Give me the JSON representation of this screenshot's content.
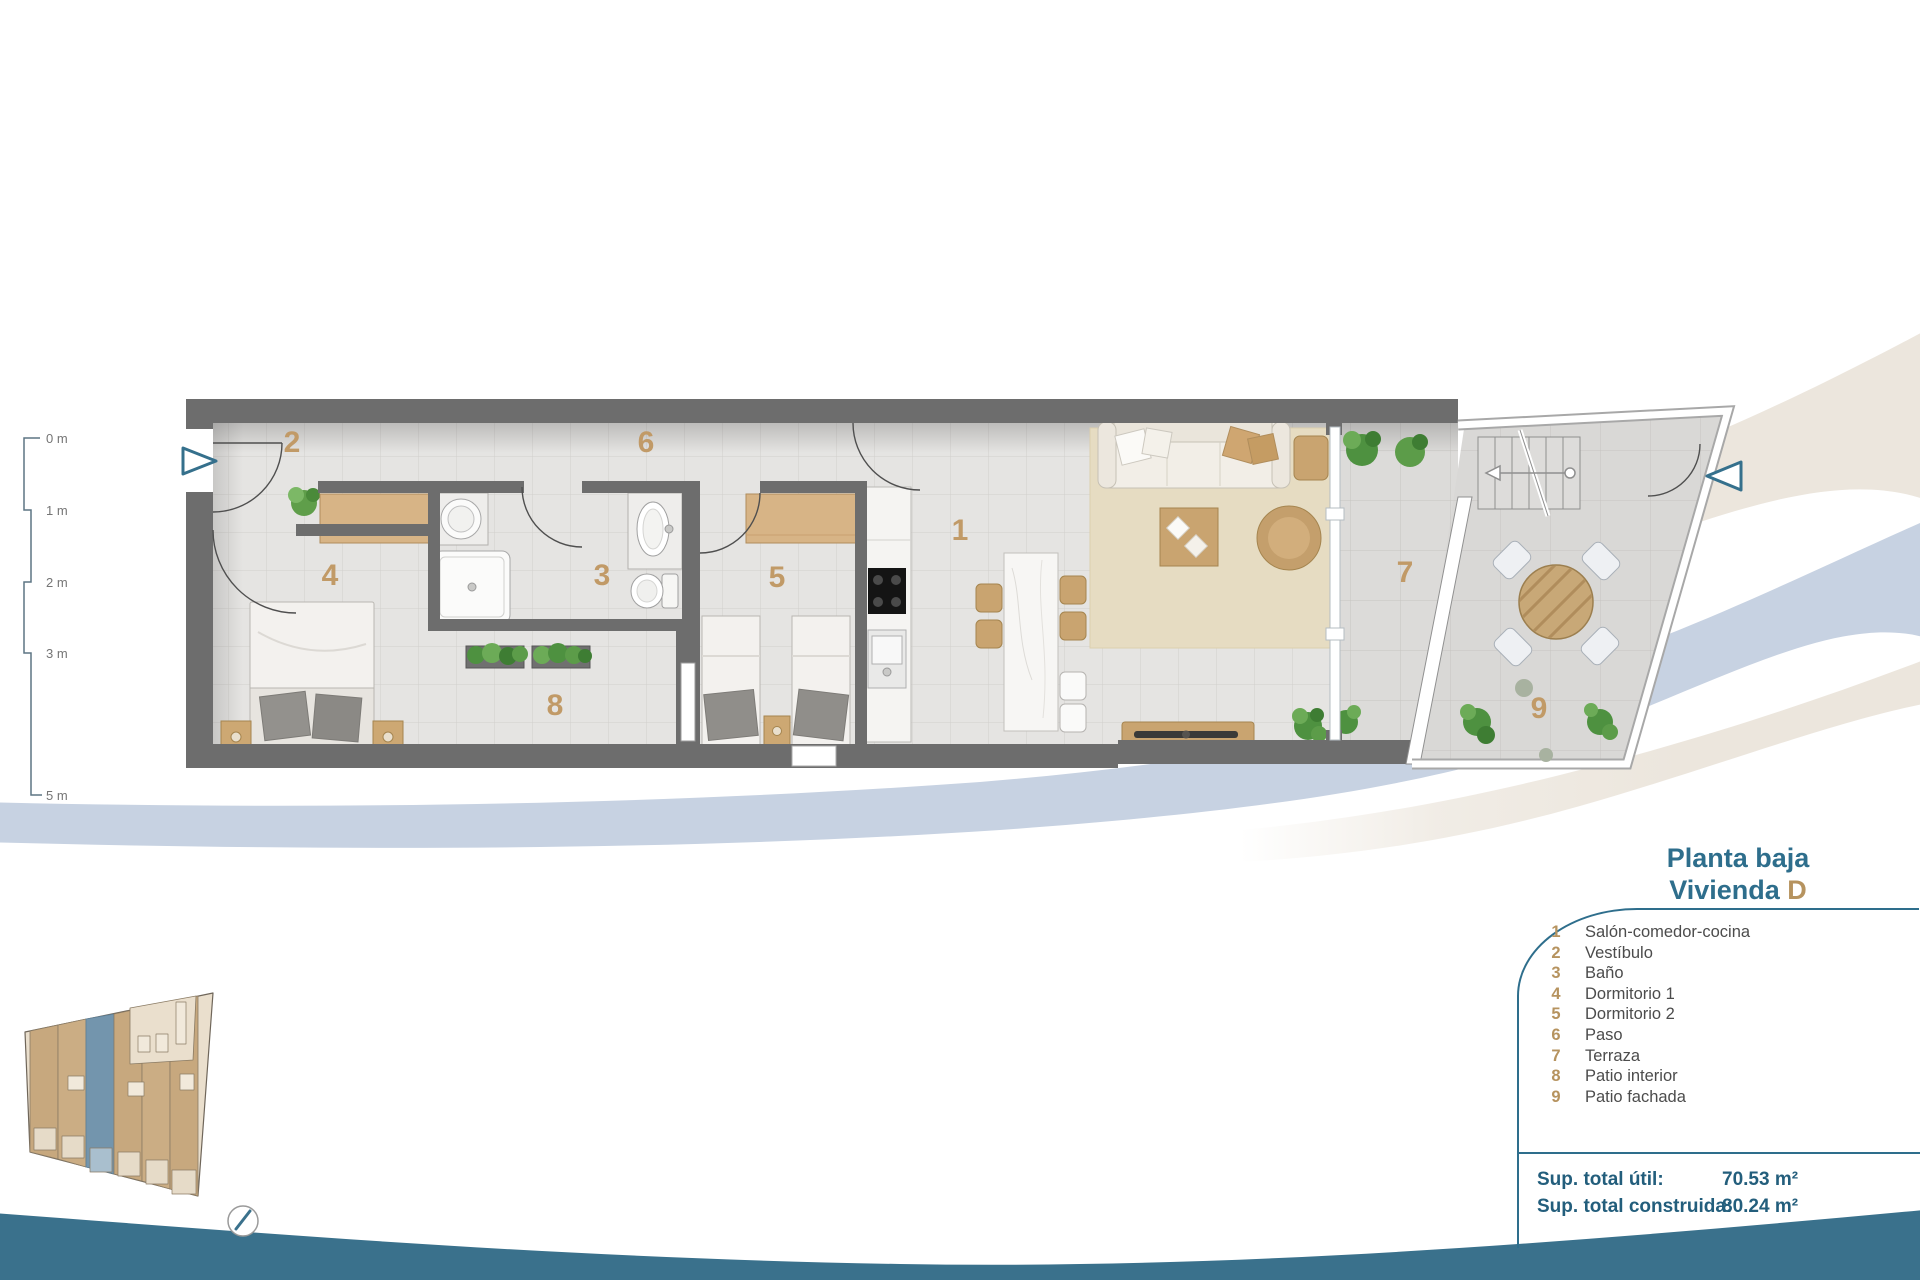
{
  "title": {
    "line1": "Planta baja",
    "line2_label": "Vivienda ",
    "line2_unit": "D"
  },
  "legend": {
    "items": [
      {
        "num": "1",
        "label": "Salón-comedor-cocina"
      },
      {
        "num": "2",
        "label": "Vestíbulo"
      },
      {
        "num": "3",
        "label": "Baño"
      },
      {
        "num": "4",
        "label": "Dormitorio 1"
      },
      {
        "num": "5",
        "label": "Dormitorio 2"
      },
      {
        "num": "6",
        "label": "Paso"
      },
      {
        "num": "7",
        "label": "Terraza"
      },
      {
        "num": "8",
        "label": "Patio interior"
      },
      {
        "num": "9",
        "label": "Patio fachada"
      }
    ]
  },
  "totals": {
    "rows": [
      {
        "label": "Sup. total útil:",
        "value": "70.53 m²"
      },
      {
        "label": "Sup. total construida:",
        "value": "80.24 m²"
      }
    ]
  },
  "scale": {
    "labels": [
      "0 m",
      "1 m",
      "2 m",
      "3 m",
      "5 m"
    ]
  },
  "plan": {
    "rooms": [
      {
        "num": "1"
      },
      {
        "num": "2"
      },
      {
        "num": "3"
      },
      {
        "num": "4"
      },
      {
        "num": "5"
      },
      {
        "num": "6"
      },
      {
        "num": "7"
      },
      {
        "num": "8"
      },
      {
        "num": "9"
      }
    ]
  },
  "icons": {
    "entrance_arrow": "triangle-outline",
    "north_needle": "compass-needle",
    "stairs_direction": "arrow-left"
  },
  "colors": {
    "accent_teal": "#2e6e8c",
    "accent_tan": "#b6935f",
    "wall_gray": "#6d6d6d",
    "floor_gray": "#e5e4e2",
    "swoosh_beige": "#ece6dd",
    "swoosh_blue": "#c7d2e2",
    "swoosh_teal_band": "#3a718c",
    "highlighted_unit": "#7395ad"
  }
}
